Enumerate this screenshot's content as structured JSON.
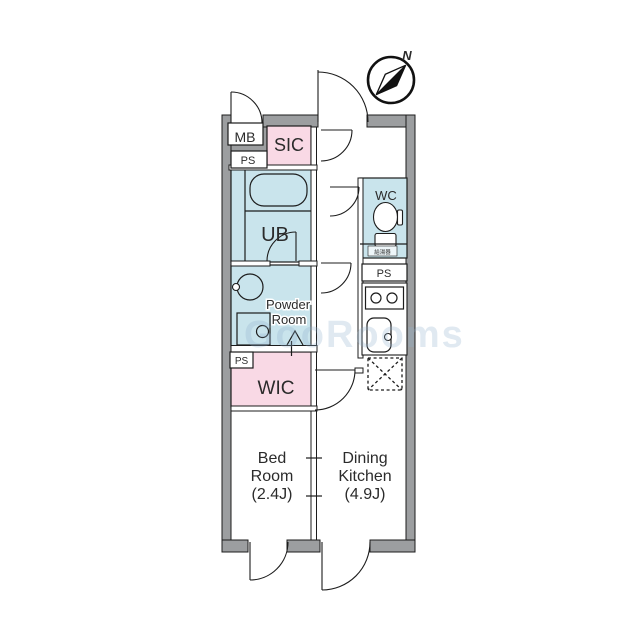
{
  "compass": {
    "north_label": "N"
  },
  "rooms": {
    "mb": "MB",
    "ps_top": "PS",
    "sic": "SIC",
    "ub": "UB",
    "wc": "WC",
    "water_heater": "給湯器",
    "ps_right": "PS",
    "powder_line1": "Powder",
    "powder_line2": "Room",
    "ps_left": "PS",
    "wic": "WIC",
    "bed_line1": "Bed",
    "bed_line2": "Room",
    "bed_line3": "(2.4J)",
    "dk_line1": "Dining",
    "dk_line2": "Kitchen",
    "dk_line3": "(4.9J)"
  },
  "watermark": "GooRooms",
  "colors": {
    "wall": "#9c9ea0",
    "wet_room": "#c9e4ec",
    "storage_room": "#f9d9e5",
    "heater_box": "#eef6f9",
    "line": "#1c1c1c"
  }
}
